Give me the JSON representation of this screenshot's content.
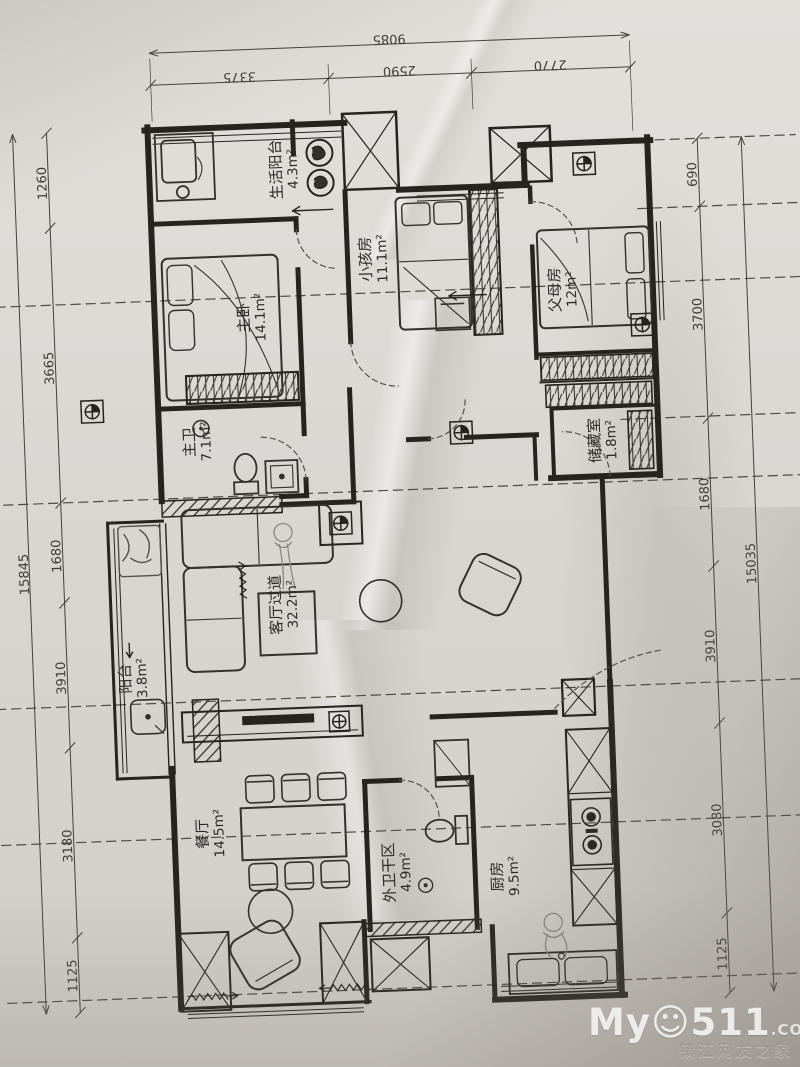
{
  "rooms": [
    {
      "name": "生活阳台",
      "area": "4.3m²"
    },
    {
      "name": "主卧",
      "area": "14.1m²"
    },
    {
      "name": "小孩房",
      "area": "11.1m²"
    },
    {
      "name": "父母房",
      "area": "12m²"
    },
    {
      "name": "主卫",
      "area": "7.1m²"
    },
    {
      "name": "储藏室",
      "area": "1.8m²"
    },
    {
      "name": "客厅过道",
      "area": "32.2m²"
    },
    {
      "name": "阳台",
      "area": "3.8m²"
    },
    {
      "name": "餐厅",
      "area": "14.5m²"
    },
    {
      "name": "外卫干区",
      "area": "4.9m²"
    },
    {
      "name": "厨房",
      "area": "9.5m²"
    }
  ],
  "dimensions": {
    "top": {
      "overall": "9085",
      "segments": [
        "3375",
        "2590",
        "2770"
      ]
    },
    "left": {
      "overall": "15845",
      "segments": [
        "1260",
        "3665",
        "1680",
        "3910",
        "3180",
        "1125"
      ]
    },
    "right": {
      "overall": "15035",
      "segments": [
        "690",
        "3700",
        "1680",
        "3910",
        "3080",
        "1125"
      ]
    }
  },
  "watermark": {
    "brand_prefix": "My",
    "smiley": "☺",
    "brand_suffix": "511",
    "tld": ".COM",
    "subtitle": "镇江网友之家"
  },
  "colors": {
    "ink": "#2b2a26",
    "paper": "#d9d6d2"
  }
}
